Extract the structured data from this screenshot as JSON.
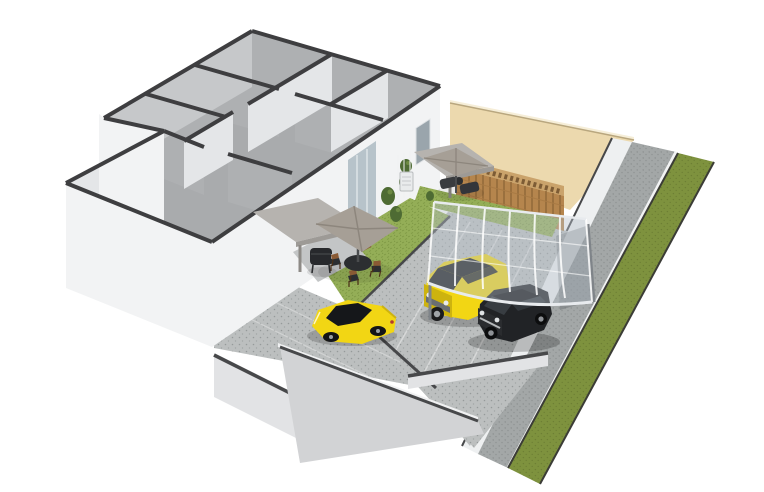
{
  "app": {
    "type": "3d-floor-plan-render",
    "view": "isometric-cutaway"
  },
  "canvas": {
    "width": 764,
    "height": 492,
    "background": "#ffffff"
  },
  "colors": {
    "background": "#ffffff",
    "wall_cap": "#3e3e40",
    "wall_face_bright": "#f2f3f4",
    "wall_face_light": "#e4e6e8",
    "wall_face_shaded": "#c6c8ca",
    "wall_inner_dark": "#aeb0b2",
    "floor": "#a9abad",
    "beige_wall": "#ecd9ae",
    "beige_cap": "#f6eed8",
    "fence_wood": "#b5854d",
    "fence_wood_dark": "#8f6637",
    "fence_rail": "#a87a44",
    "fence_lattice": "#caa36b",
    "lawn_base": "#94ae57",
    "lawn_tex": "#7e9844",
    "verge_base": "#7e923e",
    "verge_tex": "#6d7f34",
    "pavement_base": "#bcbfbf",
    "pavement_dot": "#969a9a",
    "alley_base": "#a3a7a7",
    "alley_dot": "#8a8e8e",
    "front_wall": "#d2d3d5",
    "front_wall_top": "#f0f1f2",
    "low_wall": "#e2e3e5",
    "low_wall_bright": "#eef0f1",
    "seam": "#47484a",
    "carport_glass": "#b7c1cb",
    "carport_frame": "#e8ebee",
    "carport_post": "#7f8489",
    "car_yellow": "#f2d614",
    "car_yellow_dark": "#cdb30f",
    "car_black": "#212326",
    "car_glass": "#15171a",
    "car_grille": "#6a6e71",
    "chrome": "#b6b9bb",
    "umbrella": "#a69f96",
    "umbrella_dark": "#8d867d",
    "pergola": "#b6b3af",
    "pergola_edge": "#9d9a96",
    "table_dark": "#2c2e31",
    "chair_wood": "#8a5a34",
    "grill_black": "#27292c",
    "shelf_gray": "#c9ccce",
    "plant": "#4e6b33",
    "plant_light": "#6d8a43",
    "glass_door": "#b7c3ca",
    "window_glass": "#9aa5ac",
    "ac_unit": "#e9ebec"
  },
  "scene": {
    "objects": [
      "house-cutaway-walls",
      "room-floors",
      "glass-sliding-door",
      "window",
      "neighbor-boundary-wall",
      "wooden-fence",
      "lattice-fence-top",
      "side-alley-pavement",
      "grass-verge",
      "boundary-low-wall",
      "backyard-lawn",
      "rear-lawn-strip",
      "terrace-pad",
      "pergola-awning",
      "cantilever-umbrella-dining",
      "cantilever-umbrella-lounge",
      "outdoor-dining-table",
      "outdoor-chairs",
      "bbq-grill",
      "lounge-seats",
      "wall-ac-unit",
      "climbing-plants",
      "parking-court",
      "driveway",
      "entrance-apron",
      "front-boundary-wall",
      "gate-low-wall",
      "carport-canopy",
      "carport-frame",
      "yellow-suv",
      "black-suv",
      "yellow-sports-car"
    ]
  }
}
